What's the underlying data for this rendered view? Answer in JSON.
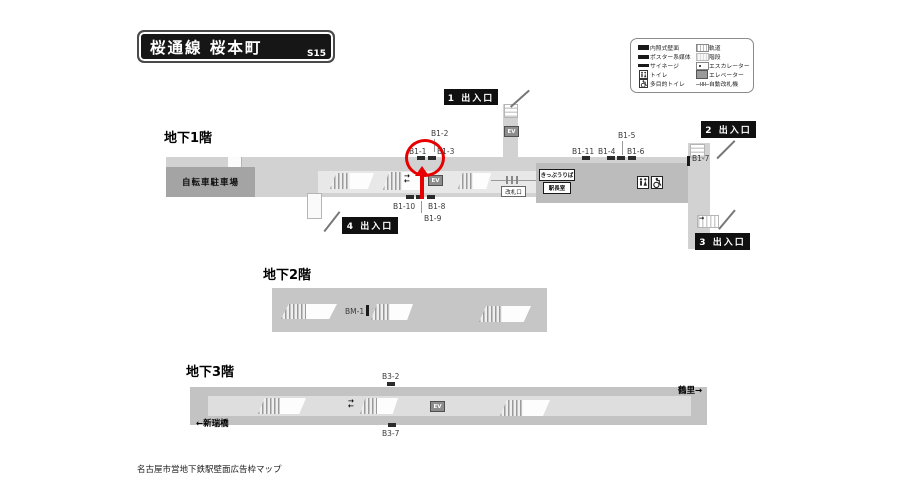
{
  "title": {
    "text": "桜通線 桜本町",
    "code": "S15"
  },
  "legend": {
    "items_left": [
      {
        "icon": "illuminated-wall-icon",
        "label": "内照式壁面"
      },
      {
        "icon": "poster-media-icon",
        "label": "ポスター系媒体"
      },
      {
        "icon": "signage-icon",
        "label": "サイネージ"
      },
      {
        "icon": "toilet-icon",
        "label": "トイレ"
      },
      {
        "icon": "accessible-toilet-icon",
        "label": "多目的トイレ"
      }
    ],
    "items_right": [
      {
        "icon": "track-icon",
        "label": "軌道"
      },
      {
        "icon": "stairs-icon",
        "label": "階段"
      },
      {
        "icon": "escalator-icon",
        "label": "エスカレーター"
      },
      {
        "icon": "elevator-icon",
        "label": "エレベーター"
      },
      {
        "icon": "ticket-gate-icon",
        "label": "自動改札機"
      }
    ]
  },
  "floors": {
    "b1": {
      "label": "地下1階",
      "bicycle_parking": "自転車駐車場",
      "exit1": "1 出入口",
      "exit2": "2 出入口",
      "exit3": "3 出入口",
      "exit4": "4 出入口",
      "ticket_office": "きっぷうりば",
      "station_office": "駅長室",
      "gate": "改札口",
      "ads": {
        "b1_1": "B1-1",
        "b1_2": "B1-2",
        "b1_3": "B1-3",
        "b1_4": "B1-4",
        "b1_5": "B1-5",
        "b1_6": "B1-6",
        "b1_7": "B1-7",
        "b1_8": "B1-8",
        "b1_9": "B1-9",
        "b1_10": "B1-10",
        "b1_11": "B1-11"
      }
    },
    "b2": {
      "label": "地下2階",
      "ads": {
        "bm_1": "BM-1"
      }
    },
    "b3": {
      "label": "地下3階",
      "dir_left": "←新瑞橋",
      "dir_right": "鶴里→",
      "ads": {
        "b3_2": "B3-2",
        "b3_7": "B3-7"
      }
    }
  },
  "ev": "EV",
  "icons": {
    "arrow_right": "→",
    "arrow_left": "←"
  },
  "caption": "名古屋市営地下鉄駅壁面広告枠マップ",
  "colors": {
    "annotation_red": "#e60000",
    "strip_gray": "#d2d2d2",
    "paid_area_gray": "#bcbcbc",
    "bike_gray": "#a4a4a4"
  }
}
